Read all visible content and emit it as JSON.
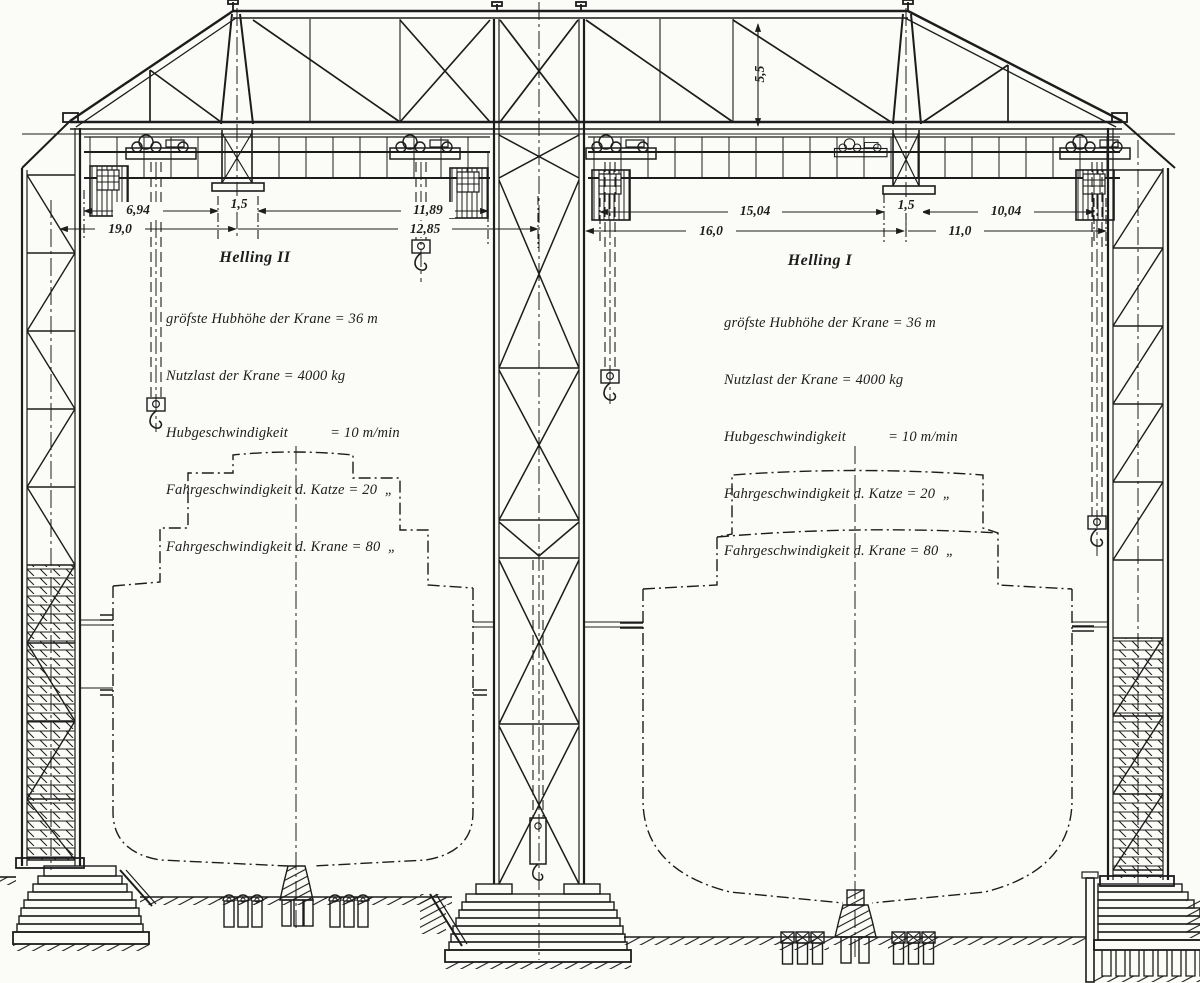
{
  "paper_color": "#fbfbf8",
  "ink_color": "#1c1c1c",
  "slipway_left": {
    "title": "Helling II",
    "specs": [
      "gröfste Hubhöhe der Krane = 36 m",
      "Nutzlast der Krane = 4000 kg",
      "Hubgeschwindigkeit           = 10 m/min",
      "Fahrgeschwindigkeit d. Katze = 20  „",
      "Fahrgeschwindigkeit d. Krane = 80  „"
    ]
  },
  "slipway_right": {
    "title": "Helling I",
    "specs": [
      "gröfste Hubhöhe der Krane = 36 m",
      "Nutzlast der Krane = 4000 kg",
      "Hubgeschwindigkeit           = 10 m/min",
      "Fahrgeschwindigkeit d. Katze = 20  „",
      "Fahrgeschwindigkeit d. Krane = 80  „"
    ]
  },
  "dimensions": {
    "left_bay_upper_a": "6,94",
    "left_aframe_width": "1,5",
    "left_bay_upper_b": "11,89",
    "left_bay_lower_a": "19,0",
    "left_bay_lower_b": "12,85",
    "right_bay_upper_a": "15,04",
    "right_aframe_width": "1,5",
    "right_bay_upper_b": "10,04",
    "right_bay_lower_a": "16,0",
    "right_bay_lower_b": "11,0",
    "truss_depth": "5,5"
  }
}
